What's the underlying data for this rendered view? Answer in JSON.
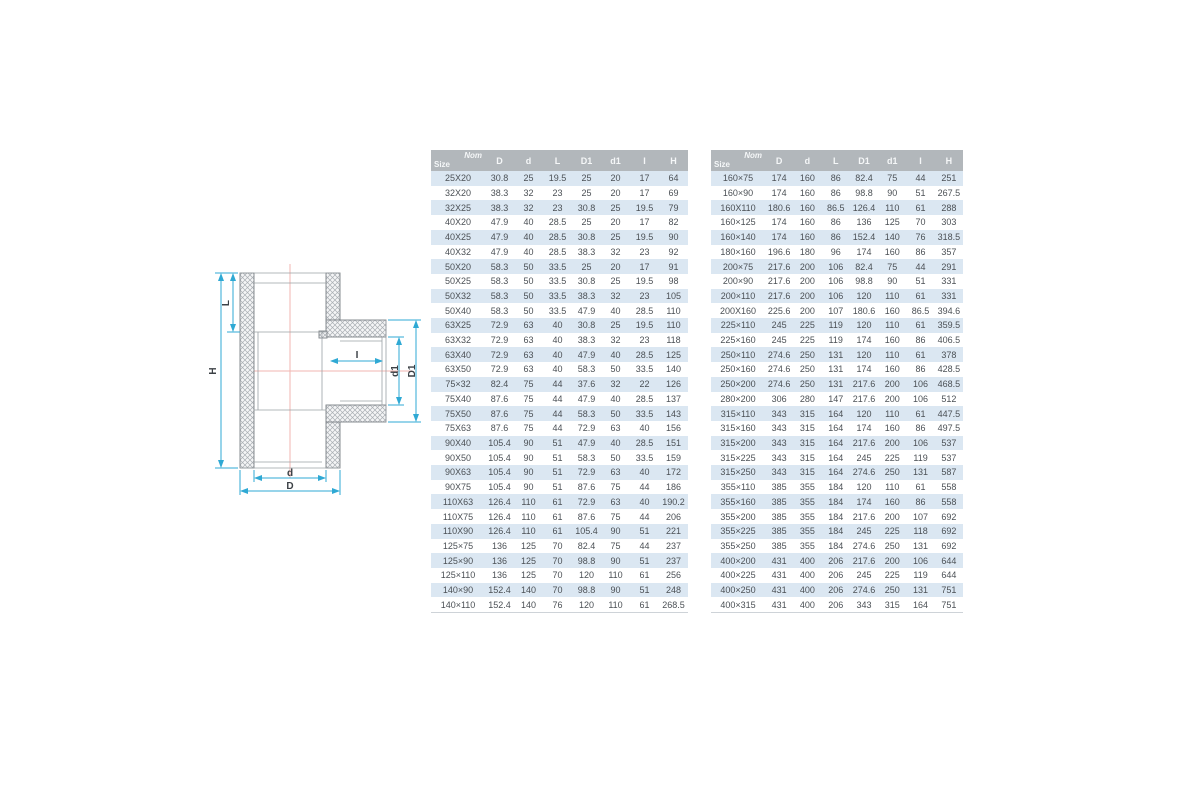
{
  "diagram": {
    "labels": {
      "H": "H",
      "L": "L",
      "I": "I",
      "d": "d",
      "D": "D",
      "d1": "d1",
      "D1": "D1"
    },
    "colors": {
      "dimension_line": "#2fa9d4",
      "label_text": "#3c4146",
      "centerline": "#f2b6b0",
      "outline": "#7b8085",
      "hatch_line": "#a9aeb3",
      "wall_fill": "#f4f5f6"
    }
  },
  "tables": {
    "corner": {
      "top": "Nom",
      "bottom": "Size"
    },
    "columns": [
      "D",
      "d",
      "L",
      "D1",
      "d1",
      "I",
      "H"
    ],
    "left": {
      "rows": [
        [
          "25X20",
          "30.8",
          "25",
          "19.5",
          "25",
          "20",
          "17",
          "64"
        ],
        [
          "32X20",
          "38.3",
          "32",
          "23",
          "25",
          "20",
          "17",
          "69"
        ],
        [
          "32X25",
          "38.3",
          "32",
          "23",
          "30.8",
          "25",
          "19.5",
          "79"
        ],
        [
          "40X20",
          "47.9",
          "40",
          "28.5",
          "25",
          "20",
          "17",
          "82"
        ],
        [
          "40X25",
          "47.9",
          "40",
          "28.5",
          "30.8",
          "25",
          "19.5",
          "90"
        ],
        [
          "40X32",
          "47.9",
          "40",
          "28.5",
          "38.3",
          "32",
          "23",
          "92"
        ],
        [
          "50X20",
          "58.3",
          "50",
          "33.5",
          "25",
          "20",
          "17",
          "91"
        ],
        [
          "50X25",
          "58.3",
          "50",
          "33.5",
          "30.8",
          "25",
          "19.5",
          "98"
        ],
        [
          "50X32",
          "58.3",
          "50",
          "33.5",
          "38.3",
          "32",
          "23",
          "105"
        ],
        [
          "50X40",
          "58.3",
          "50",
          "33.5",
          "47.9",
          "40",
          "28.5",
          "110"
        ],
        [
          "63X25",
          "72.9",
          "63",
          "40",
          "30.8",
          "25",
          "19.5",
          "110"
        ],
        [
          "63X32",
          "72.9",
          "63",
          "40",
          "38.3",
          "32",
          "23",
          "118"
        ],
        [
          "63X40",
          "72.9",
          "63",
          "40",
          "47.9",
          "40",
          "28.5",
          "125"
        ],
        [
          "63X50",
          "72.9",
          "63",
          "40",
          "58.3",
          "50",
          "33.5",
          "140"
        ],
        [
          "75×32",
          "82.4",
          "75",
          "44",
          "37.6",
          "32",
          "22",
          "126"
        ],
        [
          "75X40",
          "87.6",
          "75",
          "44",
          "47.9",
          "40",
          "28.5",
          "137"
        ],
        [
          "75X50",
          "87.6",
          "75",
          "44",
          "58.3",
          "50",
          "33.5",
          "143"
        ],
        [
          "75X63",
          "87.6",
          "75",
          "44",
          "72.9",
          "63",
          "40",
          "156"
        ],
        [
          "90X40",
          "105.4",
          "90",
          "51",
          "47.9",
          "40",
          "28.5",
          "151"
        ],
        [
          "90X50",
          "105.4",
          "90",
          "51",
          "58.3",
          "50",
          "33.5",
          "159"
        ],
        [
          "90X63",
          "105.4",
          "90",
          "51",
          "72.9",
          "63",
          "40",
          "172"
        ],
        [
          "90X75",
          "105.4",
          "90",
          "51",
          "87.6",
          "75",
          "44",
          "186"
        ],
        [
          "110X63",
          "126.4",
          "110",
          "61",
          "72.9",
          "63",
          "40",
          "190.2"
        ],
        [
          "110X75",
          "126.4",
          "110",
          "61",
          "87.6",
          "75",
          "44",
          "206"
        ],
        [
          "110X90",
          "126.4",
          "110",
          "61",
          "105.4",
          "90",
          "51",
          "221"
        ],
        [
          "125×75",
          "136",
          "125",
          "70",
          "82.4",
          "75",
          "44",
          "237"
        ],
        [
          "125×90",
          "136",
          "125",
          "70",
          "98.8",
          "90",
          "51",
          "237"
        ],
        [
          "125×110",
          "136",
          "125",
          "70",
          "120",
          "110",
          "61",
          "256"
        ],
        [
          "140×90",
          "152.4",
          "140",
          "70",
          "98.8",
          "90",
          "51",
          "248"
        ],
        [
          "140×110",
          "152.4",
          "140",
          "76",
          "120",
          "110",
          "61",
          "268.5"
        ]
      ]
    },
    "right": {
      "rows": [
        [
          "160×75",
          "174",
          "160",
          "86",
          "82.4",
          "75",
          "44",
          "251"
        ],
        [
          "160×90",
          "174",
          "160",
          "86",
          "98.8",
          "90",
          "51",
          "267.5"
        ],
        [
          "160X110",
          "180.6",
          "160",
          "86.5",
          "126.4",
          "110",
          "61",
          "288"
        ],
        [
          "160×125",
          "174",
          "160",
          "86",
          "136",
          "125",
          "70",
          "303"
        ],
        [
          "160×140",
          "174",
          "160",
          "86",
          "152.4",
          "140",
          "76",
          "318.5"
        ],
        [
          "180×160",
          "196.6",
          "180",
          "96",
          "174",
          "160",
          "86",
          "357"
        ],
        [
          "200×75",
          "217.6",
          "200",
          "106",
          "82.4",
          "75",
          "44",
          "291"
        ],
        [
          "200×90",
          "217.6",
          "200",
          "106",
          "98.8",
          "90",
          "51",
          "331"
        ],
        [
          "200×110",
          "217.6",
          "200",
          "106",
          "120",
          "110",
          "61",
          "331"
        ],
        [
          "200X160",
          "225.6",
          "200",
          "107",
          "180.6",
          "160",
          "86.5",
          "394.6"
        ],
        [
          "225×110",
          "245",
          "225",
          "119",
          "120",
          "110",
          "61",
          "359.5"
        ],
        [
          "225×160",
          "245",
          "225",
          "119",
          "174",
          "160",
          "86",
          "406.5"
        ],
        [
          "250×110",
          "274.6",
          "250",
          "131",
          "120",
          "110",
          "61",
          "378"
        ],
        [
          "250×160",
          "274.6",
          "250",
          "131",
          "174",
          "160",
          "86",
          "428.5"
        ],
        [
          "250×200",
          "274.6",
          "250",
          "131",
          "217.6",
          "200",
          "106",
          "468.5"
        ],
        [
          "280×200",
          "306",
          "280",
          "147",
          "217.6",
          "200",
          "106",
          "512"
        ],
        [
          "315×110",
          "343",
          "315",
          "164",
          "120",
          "110",
          "61",
          "447.5"
        ],
        [
          "315×160",
          "343",
          "315",
          "164",
          "174",
          "160",
          "86",
          "497.5"
        ],
        [
          "315×200",
          "343",
          "315",
          "164",
          "217.6",
          "200",
          "106",
          "537"
        ],
        [
          "315×225",
          "343",
          "315",
          "164",
          "245",
          "225",
          "119",
          "537"
        ],
        [
          "315×250",
          "343",
          "315",
          "164",
          "274.6",
          "250",
          "131",
          "587"
        ],
        [
          "355×110",
          "385",
          "355",
          "184",
          "120",
          "110",
          "61",
          "558"
        ],
        [
          "355×160",
          "385",
          "355",
          "184",
          "174",
          "160",
          "86",
          "558"
        ],
        [
          "355×200",
          "385",
          "355",
          "184",
          "217.6",
          "200",
          "107",
          "692"
        ],
        [
          "355×225",
          "385",
          "355",
          "184",
          "245",
          "225",
          "118",
          "692"
        ],
        [
          "355×250",
          "385",
          "355",
          "184",
          "274.6",
          "250",
          "131",
          "692"
        ],
        [
          "400×200",
          "431",
          "400",
          "206",
          "217.6",
          "200",
          "106",
          "644"
        ],
        [
          "400×225",
          "431",
          "400",
          "206",
          "245",
          "225",
          "119",
          "644"
        ],
        [
          "400×250",
          "431",
          "400",
          "206",
          "274.6",
          "250",
          "131",
          "751"
        ],
        [
          "400×315",
          "431",
          "400",
          "206",
          "343",
          "315",
          "164",
          "751"
        ]
      ]
    }
  }
}
